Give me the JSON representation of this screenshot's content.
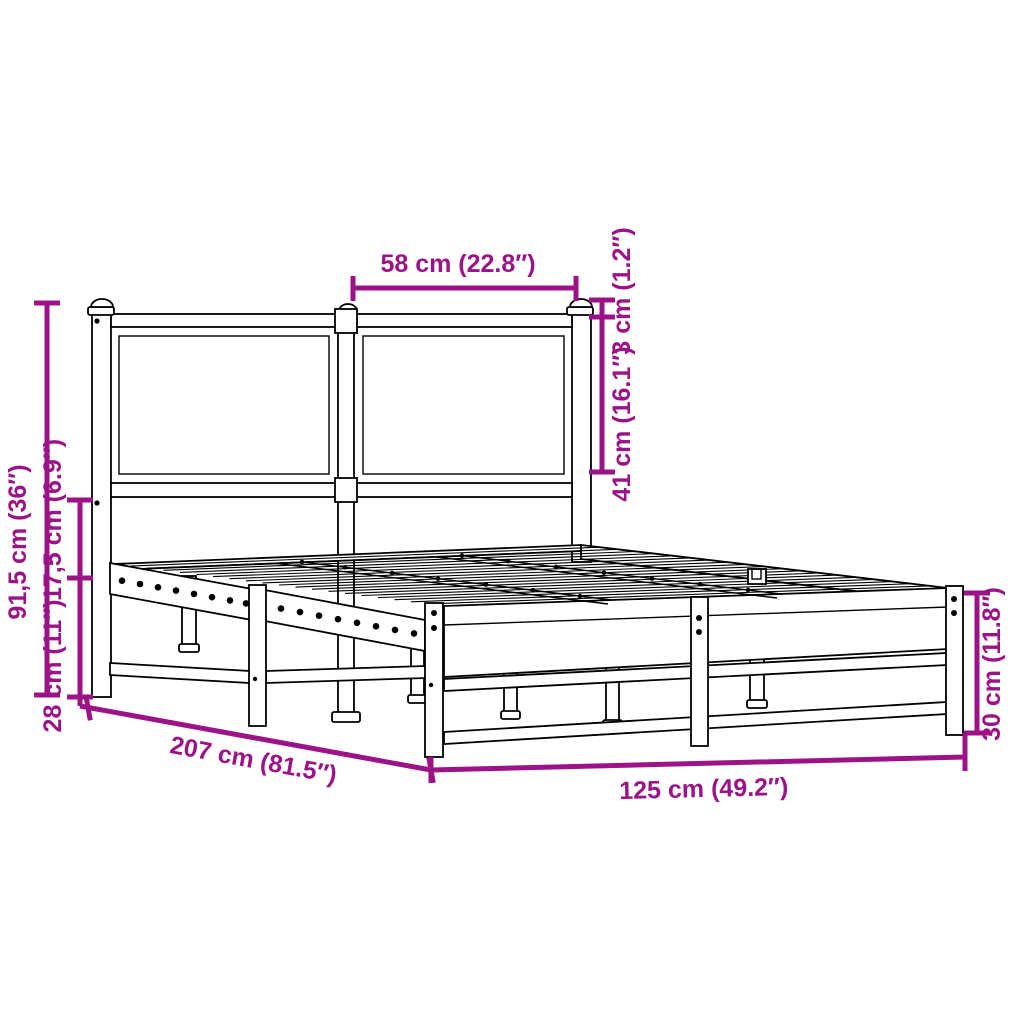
{
  "diagram": {
    "type": "product-dimension-diagram",
    "subject": "metal bed frame with headboard",
    "colors": {
      "dimension_accent": "#9B1386",
      "line_art": "#000000",
      "background": "#FFFFFF"
    },
    "dimensions": {
      "headboard_segment_width": "58 cm (22.8″)",
      "top_rail_offset": "3 cm (1.2″)",
      "headboard_panel_height": "41 cm (16.1″)",
      "headboard_height": "91,5 cm (36″)",
      "headboard_to_base_gap": "17,5 cm (6.9″)",
      "under_bed_clearance": "28 cm (11″)",
      "bed_length": "207 cm (81.5″)",
      "bed_width": "125 cm (49.2″)",
      "base_height": "30 cm (11.8″)"
    }
  }
}
